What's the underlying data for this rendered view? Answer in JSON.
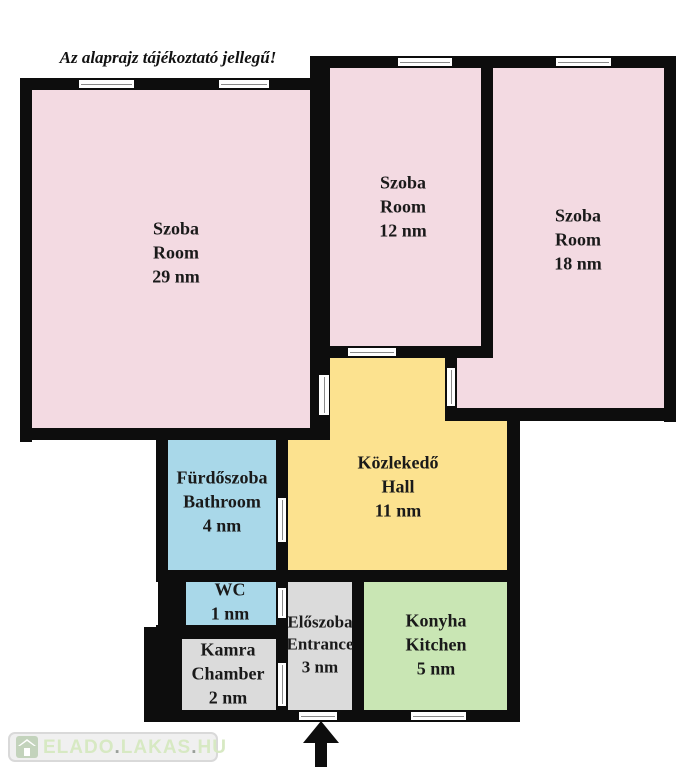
{
  "disclaimer": "Az alaprajz tájékoztató jellegű!",
  "rooms": [
    {
      "id": "room-29",
      "name_hu": "Szoba",
      "name_en": "Room",
      "area": "29 nm",
      "color": "#f3dae2"
    },
    {
      "id": "room-12",
      "name_hu": "Szoba",
      "name_en": "Room",
      "area": "12 nm",
      "color": "#f3dae2"
    },
    {
      "id": "room-18",
      "name_hu": "Szoba",
      "name_en": "Room",
      "area": "18 nm",
      "color": "#f3dae2"
    },
    {
      "id": "bathroom",
      "name_hu": "Fürdőszoba",
      "name_en": "Bathroom",
      "area": "4 nm",
      "color": "#a9d8e9"
    },
    {
      "id": "hall",
      "name_hu": "Közlekedő",
      "name_en": "Hall",
      "area": "11 nm",
      "color": "#fce28f"
    },
    {
      "id": "wc",
      "name_hu": "WC",
      "name_en": "",
      "area": "1 nm",
      "color": "#a9d8e9"
    },
    {
      "id": "chamber",
      "name_hu": "Kamra",
      "name_en": "Chamber",
      "area": "2 nm",
      "color": "#dbdbdb"
    },
    {
      "id": "entrance",
      "name_hu": "Előszoba",
      "name_en": "Entrance",
      "area": "3 nm",
      "color": "#dbdbdb"
    },
    {
      "id": "kitchen",
      "name_hu": "Konyha",
      "name_en": "Kitchen",
      "area": "5 nm",
      "color": "#c9e6b4"
    }
  ],
  "watermark": {
    "icon": "house-icon",
    "text_parts": [
      "ELADO",
      ".",
      "LAKAS",
      ".",
      "HU"
    ],
    "text_color": "#d7e9c3",
    "dot_color": "#9aa09a"
  },
  "colors": {
    "wall": "#0d0d0d",
    "background": "#ffffff",
    "room_pink": "#f3dae2",
    "hall_yellow": "#fce28f",
    "bath_blue": "#a9d8e9",
    "kitchen_green": "#c9e6b4",
    "utility_gray": "#dbdbdb"
  }
}
